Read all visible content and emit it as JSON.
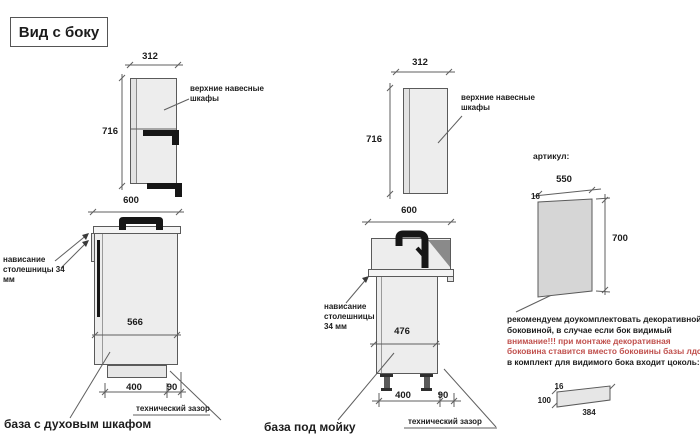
{
  "title": "Вид с боку",
  "oven": {
    "wall": {
      "w": "312",
      "h": "716",
      "label": "верхние навесные шкафы"
    },
    "base": {
      "w": "600",
      "depth": "566",
      "plinth": "400",
      "gap": "90",
      "overhang": "нависание столешницы 34 мм",
      "gap_label": "технический зазор",
      "caption": "база с духовым шкафом"
    }
  },
  "sink": {
    "wall": {
      "w": "312",
      "h": "716",
      "label": "верхние навесные шкафы"
    },
    "base": {
      "w": "600",
      "depth": "476",
      "plinth": "400",
      "gap": "90",
      "overhang": "нависание столешницы 34 мм",
      "gap_label": "технический зазор",
      "caption": "база под мойку"
    }
  },
  "panel": {
    "heading": "артикул:",
    "w": "550",
    "t": "16",
    "h": "700",
    "note1": "рекомендуем доукомплектовать декоративной",
    "note2": "боковиной, в случае если бок видимый",
    "warn1": "внимание!!! при монтаже декоративная",
    "warn2": "боковина ставится вместо боковины базы лдсп",
    "note3": "в комплект для видимого бока входит цоколь:",
    "plinth": {
      "t": "16",
      "h": "100",
      "l": "384"
    }
  },
  "colors": {
    "red": "#c0504d",
    "fill": "#ededed",
    "top": "#f4f4f4",
    "panel": "#d6d6d6",
    "line": "#5a5a5a"
  }
}
